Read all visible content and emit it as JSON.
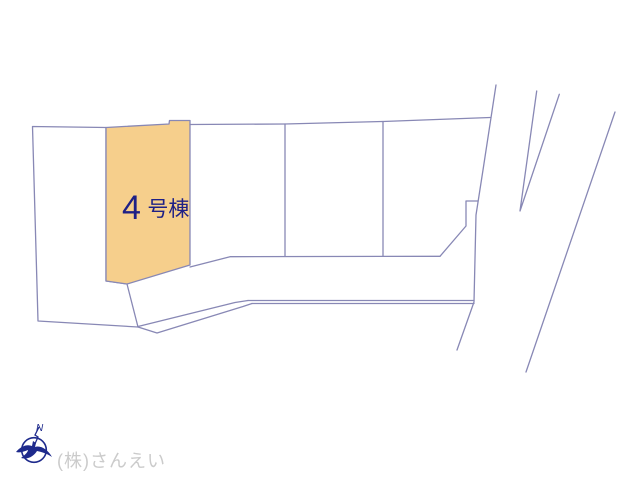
{
  "page": {
    "background": "#ffffff",
    "width": 640,
    "height": 480
  },
  "plan": {
    "type": "site-plan",
    "highlight_lot": {
      "full_label": "4号棟",
      "number": "4",
      "suffix": "号棟"
    },
    "colors": {
      "highlight_fill": "#f6cf8c",
      "line": "#8888b5",
      "label_text": "#1e2086"
    }
  },
  "compass": {
    "icon": "compass-north-bird-icon",
    "label": "N",
    "color": "#1e2a8c"
  },
  "watermark": {
    "company": "(株)さんえい",
    "color": "#cbcbcb"
  }
}
